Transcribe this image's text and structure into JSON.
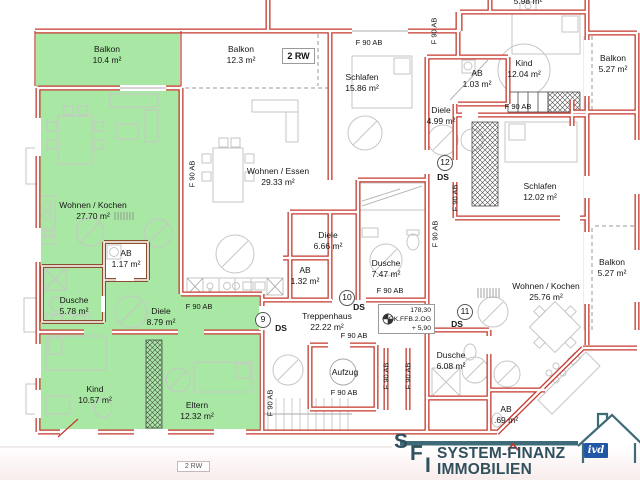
{
  "rooms": {
    "balkon_a": {
      "name": "Balkon",
      "area": "10.4 m²"
    },
    "balkon_b": {
      "name": "Balkon",
      "area": "12.3 m²"
    },
    "wohnen_kochen_a": {
      "name": "Wohnen / Kochen",
      "area": "27.70 m²"
    },
    "ab_a": {
      "name": "AB",
      "area": "1.17 m²"
    },
    "dusche_a": {
      "name": "Dusche",
      "area": "5.78 m²"
    },
    "diele_a": {
      "name": "Diele",
      "area": "8.79 m²"
    },
    "kind_a": {
      "name": "Kind",
      "area": "10.57 m²"
    },
    "eltern_a": {
      "name": "Eltern",
      "area": "12.32 m²"
    },
    "wohnen_essen_b": {
      "name": "Wohnen / Essen",
      "area": "29.33 m²"
    },
    "diele_b": {
      "name": "Diele",
      "area": "6.66 m²"
    },
    "ab_b": {
      "name": "AB",
      "area": "1.32 m²"
    },
    "dusche_b": {
      "name": "Dusche",
      "area": "7.47 m²"
    },
    "schlafen_c": {
      "name": "Schlafen",
      "area": "15.86 m²"
    },
    "ab_c": {
      "name": "AB",
      "area": "1.03 m²"
    },
    "kind_c": {
      "name": "Kind",
      "area": "12.04 m²"
    },
    "diele_c": {
      "name": "Diele",
      "area": "4.99 m²"
    },
    "balkon_c": {
      "name": "Balkon",
      "area": "5.27 m²"
    },
    "schlafen_d": {
      "name": "Schlafen",
      "area": "12.02 m²"
    },
    "balkon_d": {
      "name": "Balkon",
      "area": "5.27 m²"
    },
    "wohnen_kochen_d": {
      "name": "Wohnen / Kochen",
      "area": "25.76 m²"
    },
    "dusche_d": {
      "name": "Dusche",
      "area": "6.08 m²"
    },
    "ab_d": {
      "name": "AB",
      "area": ".69 m²"
    },
    "treppenhaus": {
      "name": "Treppenhaus",
      "area": "22.22 m²"
    },
    "aufzug": {
      "name": "Aufzug"
    },
    "partial_top": {
      "area": "5.98 m²"
    }
  },
  "annotations": {
    "fire_rating": "F 90 AB",
    "ds": "DS",
    "smoke_numbers": {
      "n9": "9",
      "n10": "10",
      "n11": "11",
      "n12": "12"
    },
    "rw_box": "2 RW",
    "rw_box_bottom": "2 RW",
    "elevation": {
      "line1": "178,30",
      "line2": "OK.FFB.2.OG",
      "line3": "+ 5,90"
    }
  },
  "logo": {
    "s": "S",
    "f": "F",
    "i": "I",
    "line1": "SYSTEM-FINANZ",
    "line2": "IMMOBILIEN",
    "ivd": "ivd"
  },
  "colors": {
    "wall_red": "#c5382e",
    "wall_brown": "#8a4f2f",
    "apartment_green": "#a9e8a4",
    "logo_slate": "#31505e",
    "logo_teal": "#3f6b79",
    "ivd_blue": "#2257a5"
  }
}
